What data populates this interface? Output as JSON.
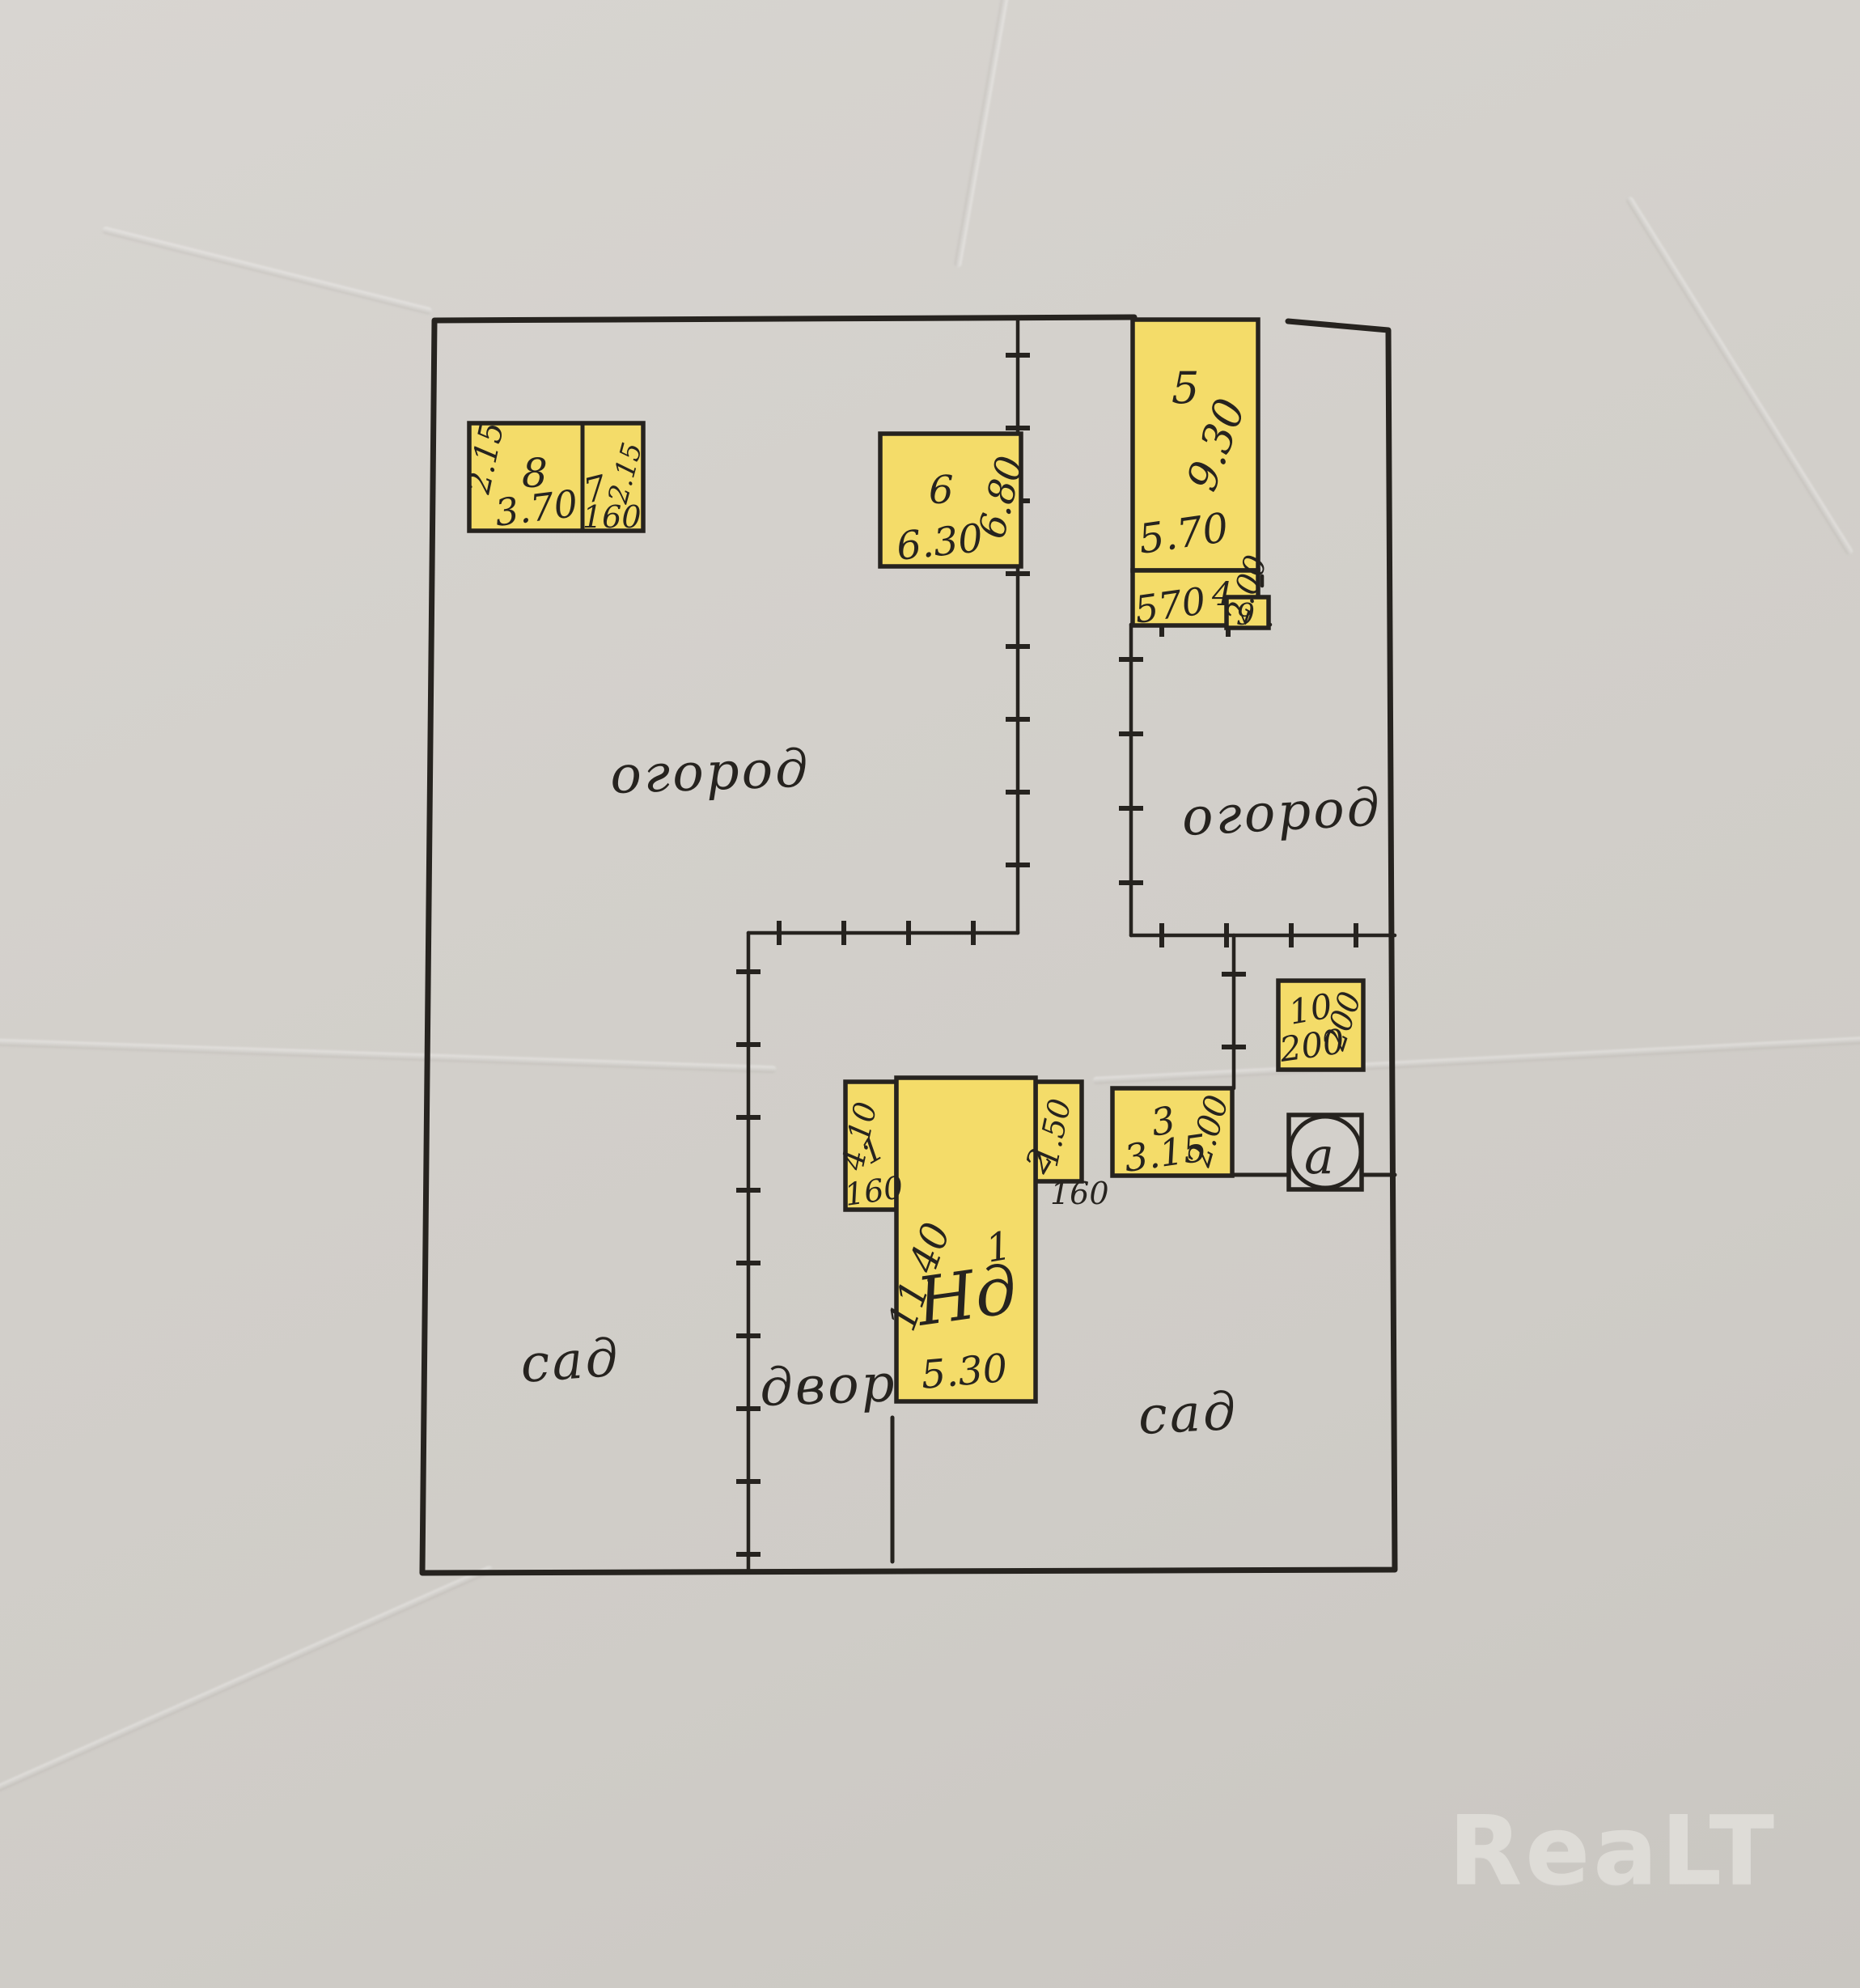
{
  "watermark": {
    "text": "ReaLT",
    "color": "#dedcd7"
  },
  "colors": {
    "paper": "#d3d0cb",
    "ink": "#26231f",
    "highlight": "#f4dc69"
  },
  "areas": {
    "garden_top_left": "огород",
    "garden_top_right": "огород",
    "orchard_left": "сад",
    "yard": "двор",
    "orchard_right": "сад"
  },
  "buildings": {
    "b8": {
      "number": "8",
      "width": "3.70",
      "height": "2.15"
    },
    "b7": {
      "number": "7",
      "width": "160",
      "height": "2.15"
    },
    "b6": {
      "number": "6",
      "width": "6.30",
      "height": "6.80"
    },
    "b5": {
      "number": "5",
      "width": "5.70",
      "height": "9.30"
    },
    "b4": {
      "number": "4",
      "width": "570",
      "height": "2.00"
    },
    "b9": {
      "number": "9"
    },
    "b10": {
      "number": "10",
      "width": "200",
      "height": "200"
    },
    "b3": {
      "number": "3",
      "width": "3.15",
      "height": "2.00"
    },
    "house": {
      "label": "Нд",
      "sup": "1",
      "width": "5.30",
      "height": "11.40"
    },
    "porch1": {
      "number": "1",
      "width": "160",
      "height": "4.10"
    },
    "porch2": {
      "number": "2",
      "width": "160",
      "height": "1.50"
    },
    "well": {
      "label": "a"
    }
  }
}
